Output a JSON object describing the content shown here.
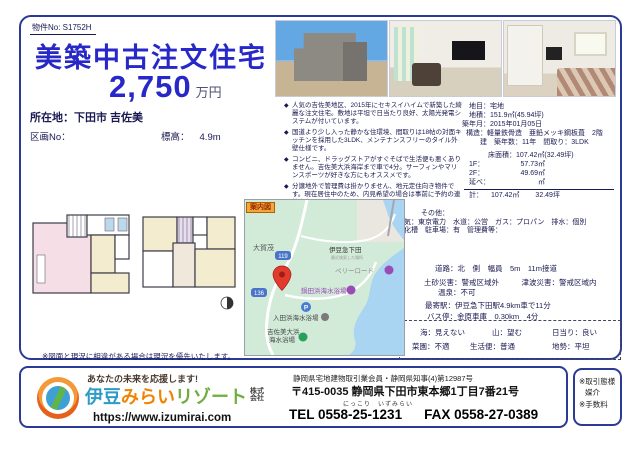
{
  "header": {
    "property_no": "物件No: S1752H",
    "title": "美築中古注文住宅",
    "price": "2,750",
    "price_unit": "万円",
    "location": "所在地：下田市 吉佐美",
    "block_no": "区画No：",
    "elevation_label": "標高：",
    "elevation_value": "4.9m"
  },
  "bullets": [
    "人気の吉佐美地区、2015年にセキスイハイムで新築した綺麗な注文住宅。敷地は平坦で日当たり良好、太陽光発電システムが付いています。",
    "国道より少し入った静かな住環境、間取りは18帖の対面キッチンを採用した3LDK、メンテナンスフリーのタイル外壁仕様です。",
    "コンビニ、ドラッグストアがすぐそばで生活便も悪くありません。吉佐美大浜海岸まで車で4分。サーフィンやマリンスポーツが好きな方にもオススメです。",
    "分譲地外で管理費は掛かりません、地元定住向き物件です。現在居住中のため、内見希望の場合は事前に予約の連絡をお願い致します。"
  ],
  "specs": {
    "land_type": "地目：宅地",
    "land_area": "地積：151.9㎡(45.94坪)",
    "built_date": "築年月：2015年01月05日",
    "structure_line1": "構造：軽量鉄骨造　亜鉛メッキ鋼板葺　2階",
    "structure_line2": "建　築年数：11年　間取り：3LDK",
    "floor_area": "床面積：107.42㎡(32.49坪)",
    "floor_1f_label": "1F：",
    "floor_1f_value": "57.73㎡",
    "floor_2f_label": "2F：",
    "floor_2f_value": "49.69㎡",
    "floor_nobe_label": "延べ：",
    "floor_nobe_value": "㎡",
    "total_label": "計：",
    "total_value": "107.42㎡",
    "total_tsubo": "32.49坪"
  },
  "other": {
    "heading": "その他：",
    "utilities_line1": "電気：東京電力　水道：公営　ガス：プロパン　排水：個別",
    "utilities_line2": "浄化槽　駐車場：有　管理費等：",
    "road": "道路：北　側　幅員　5m　11m接道",
    "hazard": "土砂災害：警戒区域外　　　津波災害：警戒区域内",
    "onsen": "温泉：不可",
    "station": "最寄駅：伊豆急下田駅4.9km車で11分",
    "bus_stop": "バス停：金原車庫　0.30km　4分"
  },
  "environment": {
    "sea": "海：見えない",
    "mountain": "山：望む",
    "sunlight": "日当り：良い",
    "garden": "菜園：不適",
    "convenience": "生活便：普通",
    "terrain": "地勢：平坦"
  },
  "floorplan": {
    "note": "※図面と現況に相違がある場合は現況を優先いたします。"
  },
  "map": {
    "badge": "案内図",
    "area_label": "大賀茂",
    "route_badge_1": "119",
    "route_badge_2": "136",
    "station_label": "伊豆急下田",
    "station_sub": "最近検索した場所",
    "perry_road": "ペリーロード",
    "beach_1": "鍋田浜海水浴場",
    "beach_2": "入田浜海水浴場",
    "beach_3_line1": "吉佐美大浜",
    "beach_3_line2": "海水浴場",
    "parking_icon": "P"
  },
  "footer": {
    "tagline": "あなたの未来を応援します!",
    "company_izu": "伊豆",
    "company_mirai": "みらい",
    "company_resort": "リゾート",
    "company_kabushiki": "株式",
    "company_kaisha": "会社",
    "url": "https://www.izumirai.com",
    "license": "静岡県宅地建物取引業会員・静岡県知事(4)第12987号",
    "postal_address": "〒415-0035 静岡県下田市東本郷1丁目7番21号",
    "phone_furigana": "にっこり　いずみらい",
    "tel": "TEL 0558-25-1231",
    "fax": "FAX 0558-27-0389",
    "transaction_type_label": "※取引態様",
    "transaction_type_value": "媒介",
    "fee_label": "※手数料"
  },
  "colors": {
    "border_navy": "#2b3a94",
    "title_blue": "#2828c8",
    "text_navy": "#1a1a52",
    "map_land": "#d2ead8",
    "map_water": "#a9d4f2",
    "badge_orange": "#f2a93b"
  }
}
